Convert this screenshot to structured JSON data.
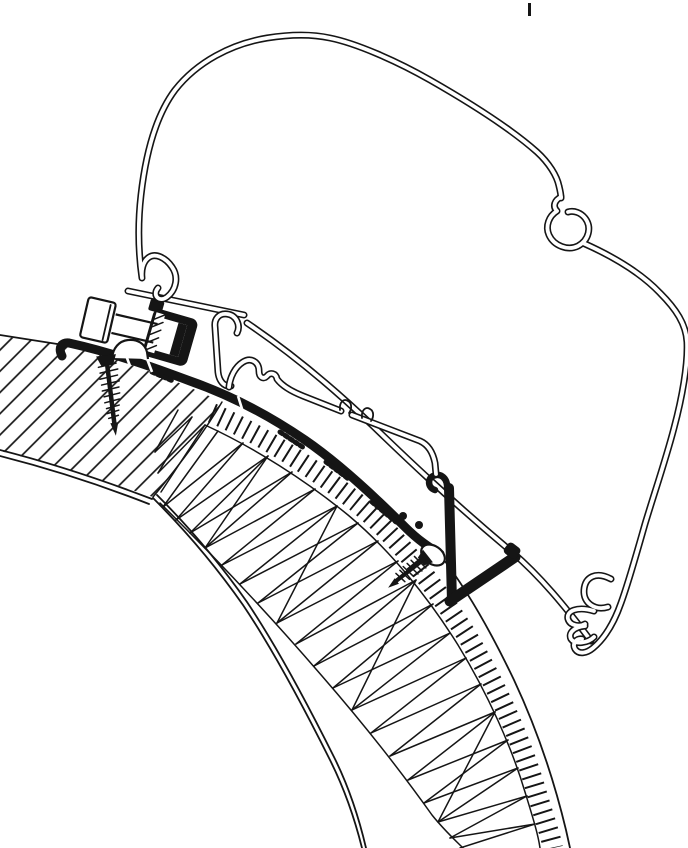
{
  "drawing": {
    "background": "#ffffff",
    "ink": "#151515"
  },
  "parts": {
    "tick": "registration-tick",
    "case": "awning-case-profile",
    "roof_panel": "roof-panel-hatched",
    "core": "wall-corner-core-hatched",
    "skin": "outer-skin-ladder-hatch",
    "base": "adapter-base-profile",
    "clamp": "adapter-clamp-block",
    "bolt": "hex-bolt",
    "screw_front": "mounting-screw-front",
    "screw_rear": "mounting-screw-rear",
    "leg": "support-leg-and-strut",
    "rail": "adapter-top-rail"
  }
}
